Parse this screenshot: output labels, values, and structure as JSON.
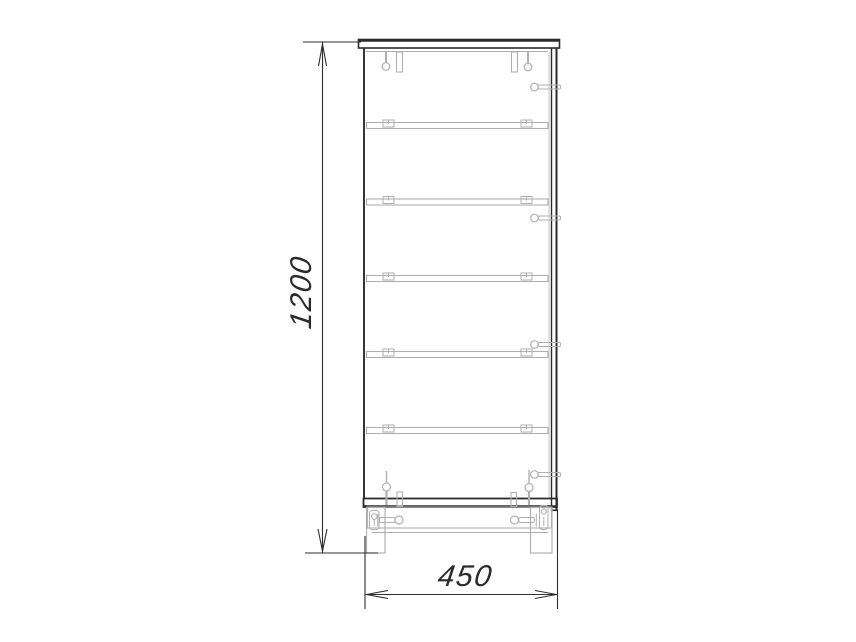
{
  "drawing": {
    "kind": "furniture-technical-drawing",
    "view": "cabinet-side-section",
    "dimensions": {
      "height": {
        "value": "1200"
      },
      "width": {
        "value": "450"
      }
    },
    "shelf_count": 5,
    "side_screw_count": 4,
    "colors": {
      "background": "#ffffff",
      "outline": "#2b2b2b",
      "hardware": "#b0b0b0",
      "dimension": "#2f2f2f"
    }
  }
}
